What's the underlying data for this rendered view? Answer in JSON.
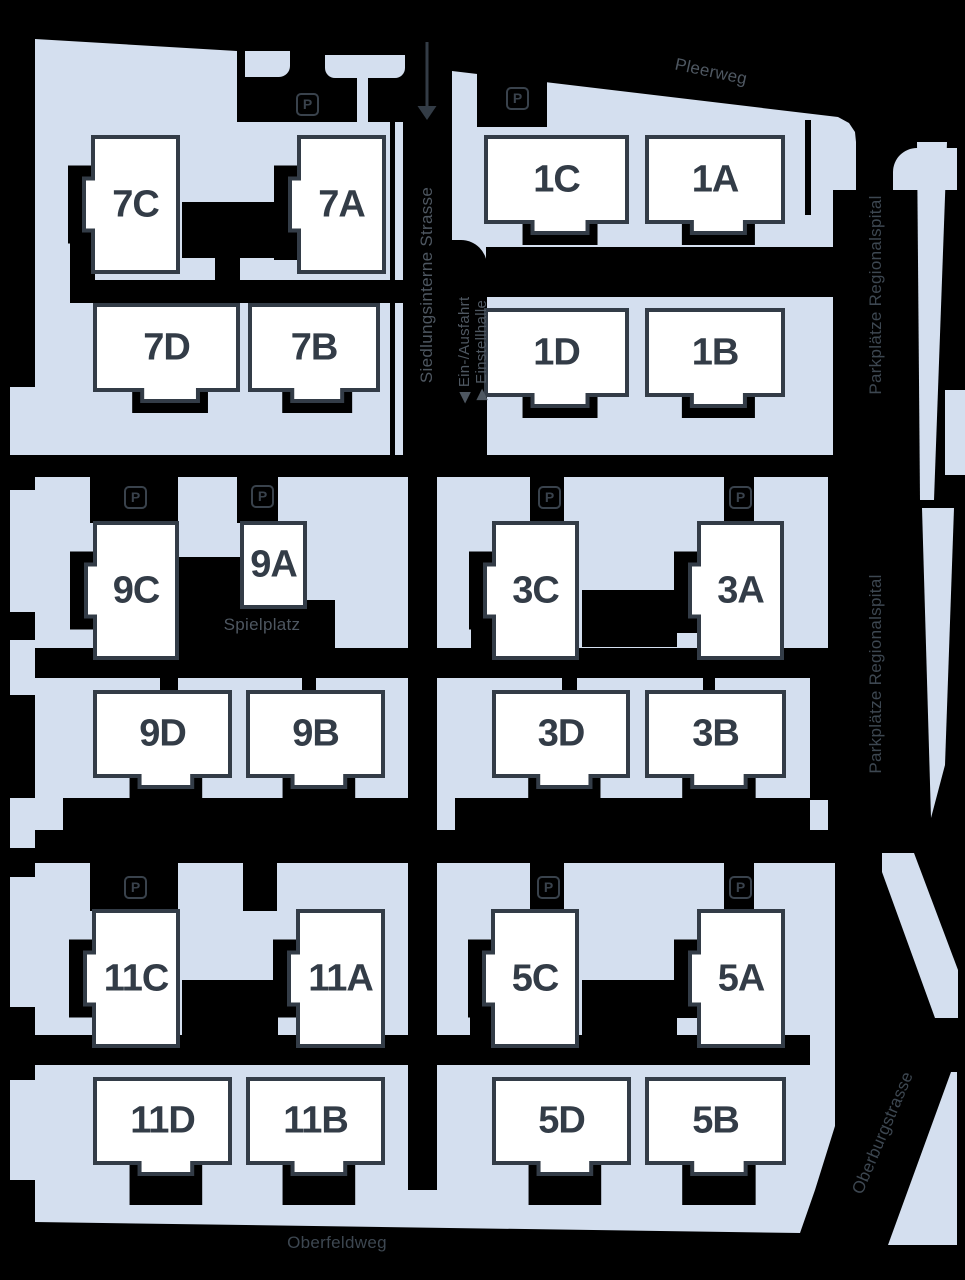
{
  "canvas": {
    "w": 965,
    "h": 1280,
    "bg": "#000000"
  },
  "colors": {
    "parcel": "#d4dfef",
    "building_fill": "#ffffff",
    "building_stroke": "#333c47",
    "building_text": "#333c47",
    "label_bright": "#4e5761",
    "label_dim": "#3d4751",
    "picon": "#39424c",
    "arrow": "#333c46"
  },
  "parking_letter": "P",
  "parking_icons": [
    {
      "x": 296,
      "y": 93
    },
    {
      "x": 506,
      "y": 87
    },
    {
      "x": 124,
      "y": 486
    },
    {
      "x": 251,
      "y": 485
    },
    {
      "x": 538,
      "y": 486
    },
    {
      "x": 729,
      "y": 486
    },
    {
      "x": 124,
      "y": 876
    },
    {
      "x": 537,
      "y": 876
    },
    {
      "x": 729,
      "y": 876
    }
  ],
  "street_labels": [
    {
      "id": "pleerweg",
      "text": "Pleerweg",
      "x": 711,
      "y": 72,
      "rot": 12,
      "size": 17,
      "tone": "bright"
    },
    {
      "id": "siedlungsinterne-strasse",
      "text": "Siedlungsinterne Strasse",
      "x": 427,
      "y": 285,
      "rot": -90,
      "size": 17,
      "tone": "bright"
    },
    {
      "id": "ein-ausfahrt",
      "text": "◀ Ein-/Ausfahrt",
      "x": 464,
      "y": 350,
      "rot": -90,
      "size": 15,
      "tone": "bright"
    },
    {
      "id": "einstellhalle",
      "text": "▶ Einstellhalle",
      "x": 481,
      "y": 350,
      "rot": -90,
      "size": 15,
      "tone": "bright"
    },
    {
      "id": "parkplaetze-regionalspital-1",
      "text": "Parkplätze Regionalspital",
      "x": 876,
      "y": 295,
      "rot": -90,
      "size": 17,
      "tone": "dim"
    },
    {
      "id": "parkplaetze-regionalspital-2",
      "text": "Parkplätze Regionalspital",
      "x": 876,
      "y": 674,
      "rot": -90,
      "size": 17,
      "tone": "dim"
    },
    {
      "id": "spielplatz",
      "text": "Spielplatz",
      "x": 262,
      "y": 625,
      "rot": 0,
      "size": 17,
      "tone": "bright"
    },
    {
      "id": "oberfeldweg",
      "text": "Oberfeldweg",
      "x": 337,
      "y": 1243,
      "rot": 0,
      "size": 17,
      "tone": "dim"
    },
    {
      "id": "oberburgstrasse",
      "text": "Oberburgstrasse",
      "x": 883,
      "y": 1133,
      "rot": -67,
      "size": 17,
      "tone": "dim"
    }
  ],
  "entrance_arrow": {
    "x": 427,
    "y": 42,
    "line_len": 64,
    "head_w": 19,
    "head_h": 14
  },
  "buildings": [
    {
      "label": "7C",
      "x": 93,
      "y": 137,
      "w": 85,
      "h": 135,
      "type": "left"
    },
    {
      "label": "7A",
      "x": 299,
      "y": 137,
      "w": 85,
      "h": 135,
      "type": "left"
    },
    {
      "label": "7D",
      "x": 95,
      "y": 305,
      "w": 143,
      "h": 85,
      "type": "bottom"
    },
    {
      "label": "7B",
      "x": 250,
      "y": 305,
      "w": 128,
      "h": 85,
      "type": "bottom"
    },
    {
      "label": "1C",
      "x": 486,
      "y": 137,
      "w": 141,
      "h": 85,
      "type": "bottom"
    },
    {
      "label": "1A",
      "x": 647,
      "y": 137,
      "w": 136,
      "h": 85,
      "type": "bottom"
    },
    {
      "label": "1D",
      "x": 486,
      "y": 310,
      "w": 141,
      "h": 85,
      "type": "bottom"
    },
    {
      "label": "1B",
      "x": 647,
      "y": 310,
      "w": 136,
      "h": 85,
      "type": "bottom"
    },
    {
      "label": "9C",
      "x": 95,
      "y": 523,
      "w": 82,
      "h": 135,
      "type": "left"
    },
    {
      "label": "9A",
      "x": 242,
      "y": 523,
      "w": 63,
      "h": 84,
      "type": "plain"
    },
    {
      "label": "9D",
      "x": 95,
      "y": 692,
      "w": 135,
      "h": 84,
      "type": "bottom"
    },
    {
      "label": "9B",
      "x": 248,
      "y": 692,
      "w": 135,
      "h": 84,
      "type": "bottom"
    },
    {
      "label": "3C",
      "x": 494,
      "y": 523,
      "w": 83,
      "h": 135,
      "type": "left"
    },
    {
      "label": "3A",
      "x": 699,
      "y": 523,
      "w": 83,
      "h": 135,
      "type": "left"
    },
    {
      "label": "3D",
      "x": 494,
      "y": 692,
      "w": 134,
      "h": 84,
      "type": "bottom"
    },
    {
      "label": "3B",
      "x": 647,
      "y": 692,
      "w": 137,
      "h": 84,
      "type": "bottom"
    },
    {
      "label": "11C",
      "x": 94,
      "y": 911,
      "w": 84,
      "h": 135,
      "type": "left"
    },
    {
      "label": "11A",
      "x": 298,
      "y": 911,
      "w": 85,
      "h": 135,
      "type": "left"
    },
    {
      "label": "11D",
      "x": 95,
      "y": 1079,
      "w": 135,
      "h": 84,
      "type": "bottom",
      "padh": 42
    },
    {
      "label": "11B",
      "x": 248,
      "y": 1079,
      "w": 135,
      "h": 84,
      "type": "bottom",
      "padh": 42
    },
    {
      "label": "5C",
      "x": 493,
      "y": 911,
      "w": 84,
      "h": 135,
      "type": "left"
    },
    {
      "label": "5A",
      "x": 699,
      "y": 911,
      "w": 84,
      "h": 135,
      "type": "left"
    },
    {
      "label": "5D",
      "x": 494,
      "y": 1079,
      "w": 135,
      "h": 84,
      "type": "bottom",
      "padh": 42
    },
    {
      "label": "5B",
      "x": 647,
      "y": 1079,
      "w": 137,
      "h": 84,
      "type": "bottom",
      "padh": 42
    }
  ],
  "shapes": {
    "light": [
      {
        "kind": "poly",
        "pts": "35,39 237,51 237,122 403,122 403,455 35,455"
      },
      {
        "kind": "path",
        "d": "M245,51 h45 v15 a11,11 0 0 1 -11,11 h-34 z"
      },
      {
        "kind": "path",
        "d": "M325,55 h80 v13 a10,10 0 0 1 -10,10 h-60 a10,10 0 0 1 -10,-10 z"
      },
      {
        "kind": "rect",
        "x": 357,
        "y": 78,
        "w": 11,
        "h": 46
      },
      {
        "kind": "poly",
        "pts": "452,71 838,117 849,123 855,132 856,142 856,190 833,190 833,455 452,455"
      },
      {
        "kind": "rect",
        "x": 35,
        "y": 477,
        "w": 373,
        "h": 353
      },
      {
        "kind": "rect",
        "x": 437,
        "y": 477,
        "w": 391,
        "h": 353
      },
      {
        "kind": "rect",
        "x": 35,
        "y": 863,
        "w": 373,
        "h": 327
      },
      {
        "kind": "poly",
        "pts": "437,863 835,863 835,1126 815,1190 437,1190"
      },
      {
        "kind": "poly",
        "pts": "35,1190 815,1190 800,1233 35,1222"
      },
      {
        "kind": "rect",
        "x": 385,
        "y": 500,
        "w": 23,
        "h": 25
      },
      {
        "kind": "rect",
        "x": 385,
        "y": 545,
        "w": 23,
        "h": 120
      },
      {
        "kind": "rect",
        "x": 385,
        "y": 679,
        "w": 23,
        "h": 151
      },
      {
        "kind": "rect",
        "x": 385,
        "y": 877,
        "w": 23,
        "h": 133
      },
      {
        "kind": "rect",
        "x": 385,
        "y": 1060,
        "w": 23,
        "h": 130
      },
      {
        "kind": "rect",
        "x": 10,
        "y": 387,
        "w": 25,
        "h": 68
      },
      {
        "kind": "rect",
        "x": 10,
        "y": 490,
        "w": 25,
        "h": 122
      },
      {
        "kind": "rect",
        "x": 10,
        "y": 640,
        "w": 25,
        "h": 55
      },
      {
        "kind": "rect",
        "x": 10,
        "y": 798,
        "w": 25,
        "h": 50
      },
      {
        "kind": "rect",
        "x": 10,
        "y": 877,
        "w": 25,
        "h": 130
      },
      {
        "kind": "rect",
        "x": 10,
        "y": 1080,
        "w": 25,
        "h": 100
      },
      {
        "kind": "path",
        "d": "M893,190 v-18 a24,24 0 0 1 24,-24 h40 v42 z"
      },
      {
        "kind": "poly",
        "pts": "917,142 947,142 934,500 920,500"
      },
      {
        "kind": "poly",
        "pts": "922,508 954,508 945,765 931,818"
      },
      {
        "kind": "rect",
        "x": 945,
        "y": 390,
        "w": 20,
        "h": 85
      },
      {
        "kind": "poly",
        "pts": "882,853 914,853 958,970 958,1018 935,1018 882,872"
      },
      {
        "kind": "poly",
        "pts": "951,1072 957,1072 957,1245 888,1245"
      }
    ],
    "dark": [
      {
        "kind": "rect",
        "x": 70,
        "y": 168,
        "w": 25,
        "h": 124
      },
      {
        "kind": "rect",
        "x": 274,
        "y": 168,
        "w": 25,
        "h": 92
      },
      {
        "kind": "rect",
        "x": 182,
        "y": 202,
        "w": 96,
        "h": 56
      },
      {
        "kind": "rect",
        "x": 215,
        "y": 255,
        "w": 25,
        "h": 28
      },
      {
        "kind": "rect",
        "x": 70,
        "y": 280,
        "w": 333,
        "h": 23
      },
      {
        "kind": "rect",
        "x": 390,
        "y": 122,
        "w": 5,
        "h": 333
      },
      {
        "kind": "rect",
        "x": 477,
        "y": 62,
        "w": 70,
        "h": 65
      },
      {
        "kind": "rect",
        "x": 805,
        "y": 120,
        "w": 6,
        "h": 95
      },
      {
        "kind": "path",
        "d": "M452,240 h9 a26,26 0 0 1 26,26 v1 h-35 z"
      },
      {
        "kind": "rect",
        "x": 452,
        "y": 267,
        "w": 35,
        "h": 188
      },
      {
        "kind": "rect",
        "x": 486,
        "y": 247,
        "w": 349,
        "h": 50
      },
      {
        "kind": "rect",
        "x": 90,
        "y": 477,
        "w": 88,
        "h": 46
      },
      {
        "kind": "rect",
        "x": 237,
        "y": 477,
        "w": 41,
        "h": 46
      },
      {
        "kind": "rect",
        "x": 177,
        "y": 557,
        "w": 66,
        "h": 91
      },
      {
        "kind": "rect",
        "x": 177,
        "y": 600,
        "w": 158,
        "h": 48
      },
      {
        "kind": "rect",
        "x": 35,
        "y": 648,
        "w": 373,
        "h": 30
      },
      {
        "kind": "rect",
        "x": 160,
        "y": 678,
        "w": 18,
        "h": 14
      },
      {
        "kind": "rect",
        "x": 302,
        "y": 678,
        "w": 14,
        "h": 14
      },
      {
        "kind": "rect",
        "x": 63,
        "y": 798,
        "w": 345,
        "h": 32
      },
      {
        "kind": "rect",
        "x": 530,
        "y": 477,
        "w": 34,
        "h": 46
      },
      {
        "kind": "rect",
        "x": 724,
        "y": 477,
        "w": 30,
        "h": 46
      },
      {
        "kind": "rect",
        "x": 471,
        "y": 555,
        "w": 23,
        "h": 112
      },
      {
        "kind": "rect",
        "x": 676,
        "y": 555,
        "w": 23,
        "h": 78
      },
      {
        "kind": "rect",
        "x": 582,
        "y": 590,
        "w": 95,
        "h": 57
      },
      {
        "kind": "rect",
        "x": 437,
        "y": 648,
        "w": 391,
        "h": 30
      },
      {
        "kind": "rect",
        "x": 562,
        "y": 678,
        "w": 15,
        "h": 14
      },
      {
        "kind": "rect",
        "x": 703,
        "y": 678,
        "w": 12,
        "h": 14
      },
      {
        "kind": "rect",
        "x": 455,
        "y": 798,
        "w": 355,
        "h": 32
      },
      {
        "kind": "rect",
        "x": 810,
        "y": 660,
        "w": 18,
        "h": 140
      },
      {
        "kind": "rect",
        "x": 90,
        "y": 863,
        "w": 88,
        "h": 48
      },
      {
        "kind": "rect",
        "x": 243,
        "y": 863,
        "w": 34,
        "h": 48
      },
      {
        "kind": "rect",
        "x": 182,
        "y": 980,
        "w": 96,
        "h": 55
      },
      {
        "kind": "rect",
        "x": 35,
        "y": 1035,
        "w": 373,
        "h": 30
      },
      {
        "kind": "rect",
        "x": 530,
        "y": 863,
        "w": 34,
        "h": 48
      },
      {
        "kind": "rect",
        "x": 724,
        "y": 863,
        "w": 30,
        "h": 48
      },
      {
        "kind": "rect",
        "x": 470,
        "y": 940,
        "w": 23,
        "h": 112
      },
      {
        "kind": "rect",
        "x": 676,
        "y": 940,
        "w": 23,
        "h": 78
      },
      {
        "kind": "rect",
        "x": 582,
        "y": 980,
        "w": 95,
        "h": 57
      },
      {
        "kind": "rect",
        "x": 437,
        "y": 1035,
        "w": 373,
        "h": 30
      }
    ]
  }
}
